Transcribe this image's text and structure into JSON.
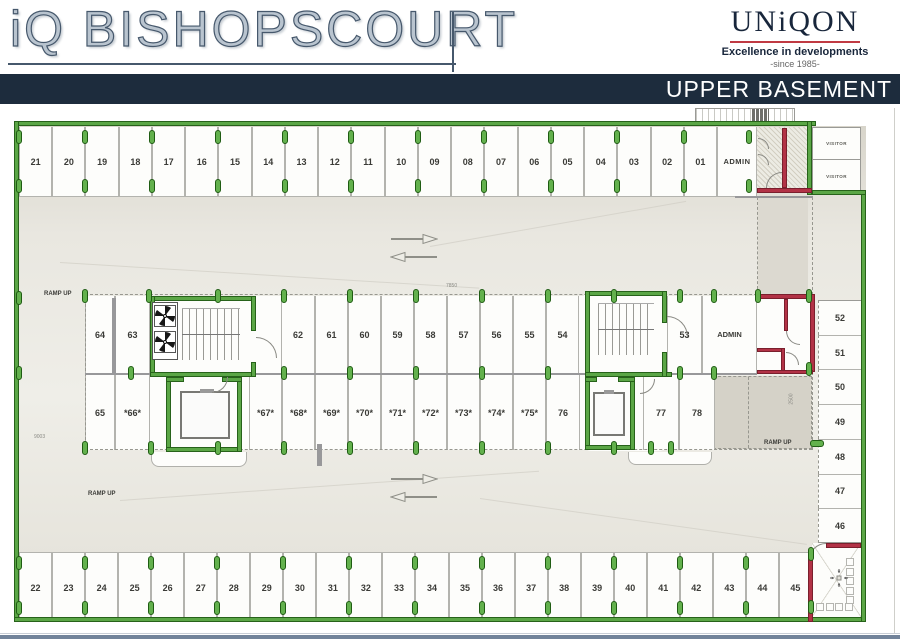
{
  "header": {
    "brand": "iQ BISHOPSCOURT",
    "developer": {
      "name": "UNiQON",
      "tagline": "Excellence in developments",
      "since": "-since 1985-"
    },
    "level_title": "UPPER BASEMENT"
  },
  "plan": {
    "stalls": {
      "top_row": [
        "21",
        "20",
        "19",
        "18",
        "17",
        "16",
        "15",
        "14",
        "13",
        "12",
        "11",
        "10",
        "09",
        "08",
        "07",
        "06",
        "05",
        "04",
        "03",
        "02",
        "01",
        "ADMIN"
      ],
      "visitor": [
        "VISITOR",
        "VISITOR"
      ],
      "middle_top": [
        "64",
        "63",
        "62",
        "61",
        "60",
        "59",
        "58",
        "57",
        "56",
        "55",
        "54",
        "53",
        "ADMIN"
      ],
      "middle_bottom": [
        "65",
        "*66*",
        "*67*",
        "*68*",
        "*69*",
        "*70*",
        "*71*",
        "*72*",
        "*73*",
        "*74*",
        "*75*",
        "76",
        "77",
        "78"
      ],
      "right_column": [
        "52",
        "51",
        "50",
        "49",
        "48",
        "47",
        "46"
      ],
      "bottom_row": [
        "22",
        "23",
        "24",
        "25",
        "26",
        "27",
        "28",
        "29",
        "30",
        "31",
        "32",
        "33",
        "34",
        "35",
        "36",
        "37",
        "38",
        "39",
        "40",
        "41",
        "42",
        "43",
        "44",
        "45"
      ]
    },
    "labels": {
      "ramp_up_top_left": "RAMP UP",
      "ramp_up_bottom_left": "RAMP UP",
      "ramp_up_right": "RAMP UP",
      "dim_top": "7850",
      "dim_left": "9003",
      "dim_ramp": "2500"
    },
    "colors": {
      "wall_green": "#5ba646",
      "wall_red": "#b23246",
      "navy_bar": "#1d2c3d",
      "logo_underline_red": "#c03a43",
      "aisle_beige": "#e7e5dd"
    },
    "icons": {
      "traffic_arrow_right": "right-arrow",
      "traffic_arrow_left": "left-arrow",
      "extract_fan": "pinwheel",
      "center_marker": "crosshair"
    }
  }
}
